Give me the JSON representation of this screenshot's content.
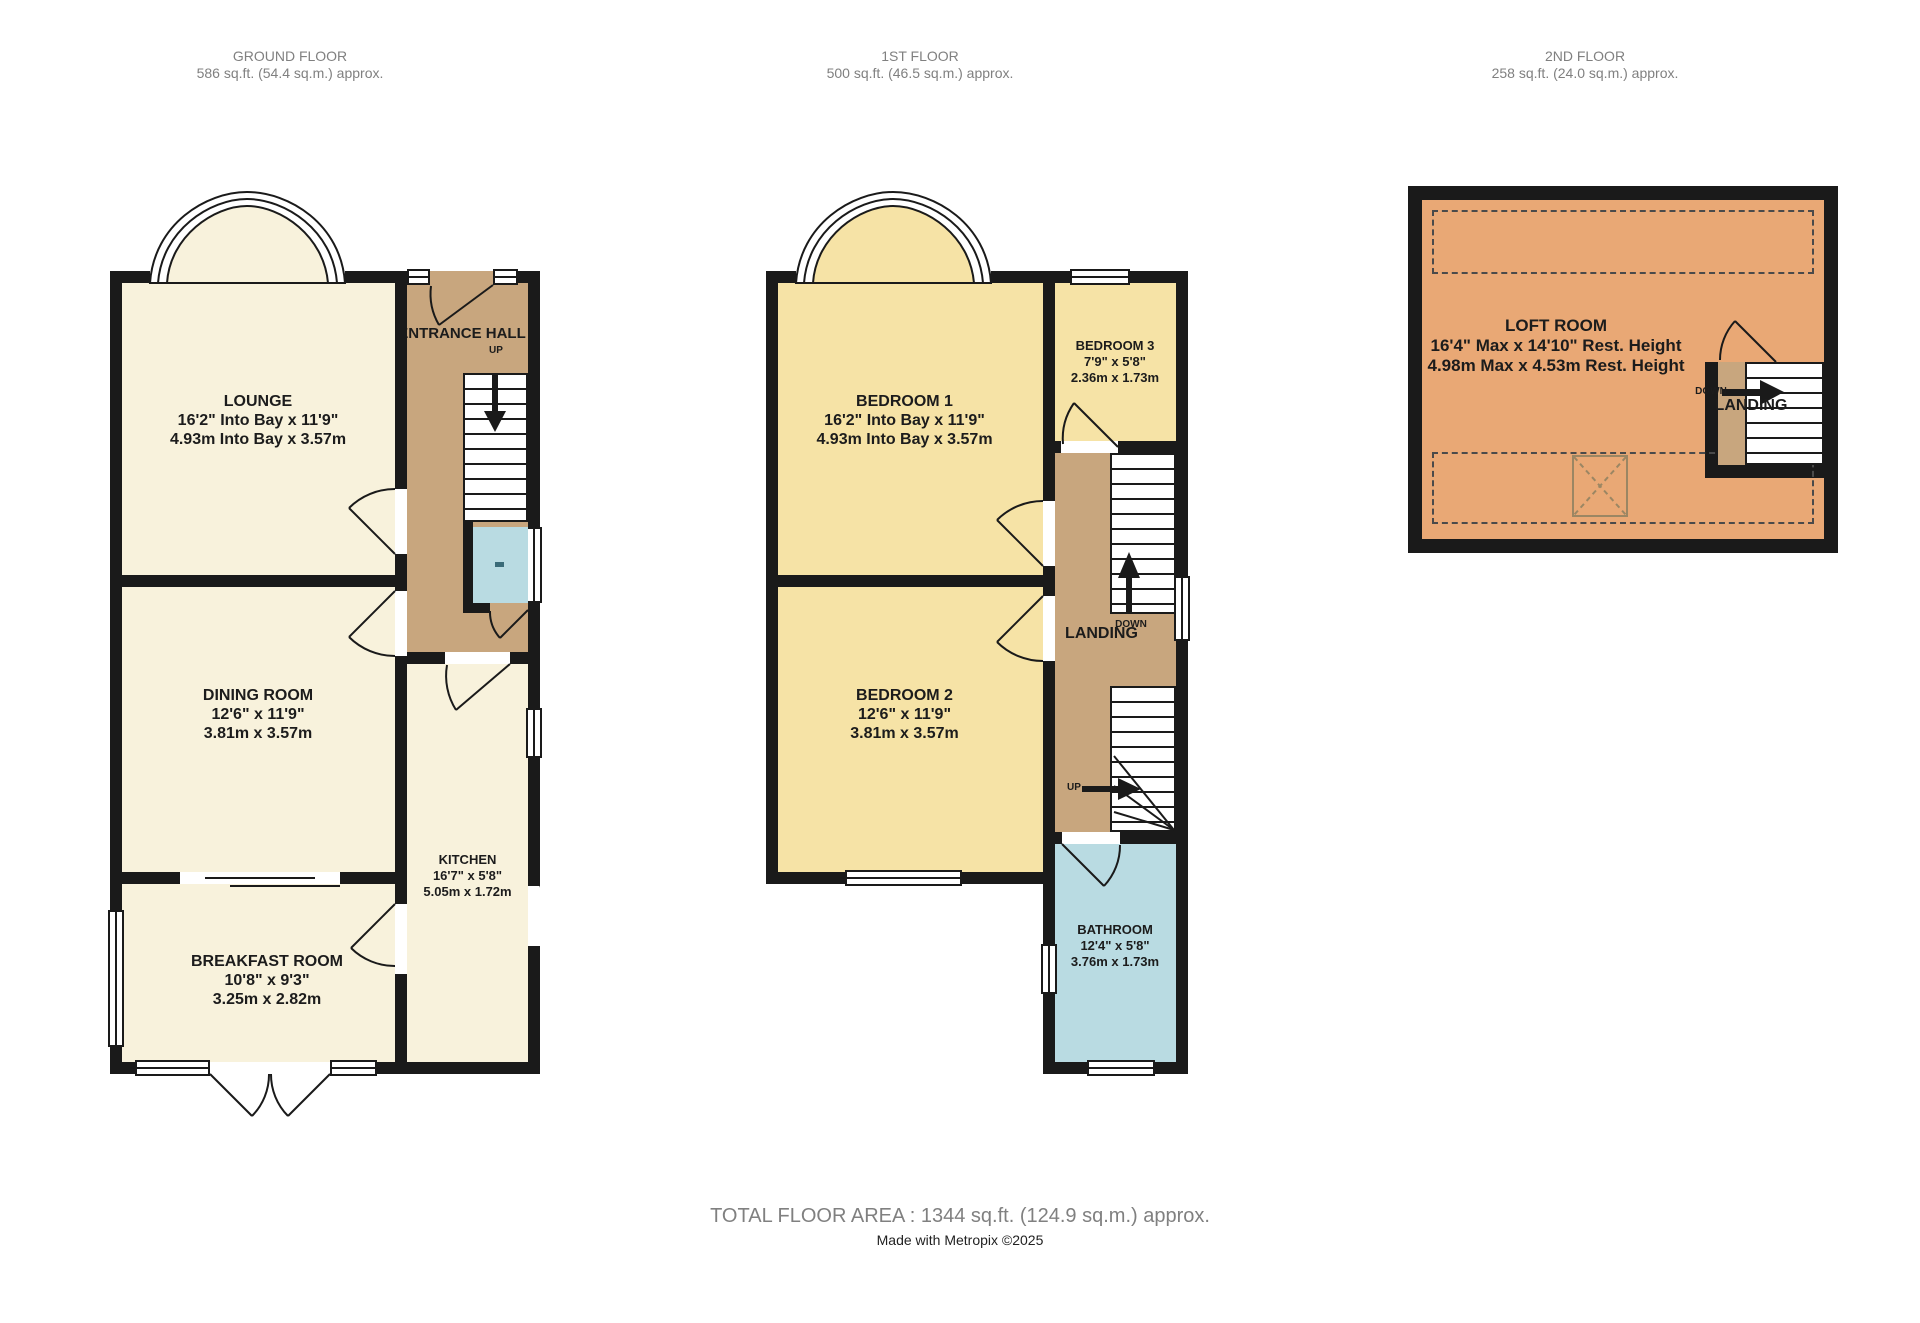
{
  "page": {
    "total_area": "TOTAL FLOOR AREA : 1344 sq.ft. (124.9 sq.m.) approx.",
    "credit": "Made with Metropix ©2025"
  },
  "colors": {
    "cream": "#f8f2dc",
    "tan": "#c8a67e",
    "yellow": "#f6e3a6",
    "blue": "#b9dbe2",
    "orange": "#e9a875",
    "wall": "#1a1a1a",
    "header_text": "#808080",
    "label_text": "#1c1c1c"
  },
  "floors": {
    "ground": {
      "title": "GROUND FLOOR",
      "area": "586 sq.ft. (54.4 sq.m.) approx.",
      "rooms": {
        "lounge": {
          "name": "LOUNGE",
          "imperial": "16'2\" Into Bay x 11'9\"",
          "metric": "4.93m Into Bay x 3.57m"
        },
        "entrance_hall": {
          "name": "ENTRANCE HALL"
        },
        "dining": {
          "name": "DINING ROOM",
          "imperial": "12'6\"  x 11'9\"",
          "metric": "3.81m  x 3.57m"
        },
        "kitchen": {
          "name": "KITCHEN",
          "imperial": "16'7\"  x 5'8\"",
          "metric": "5.05m  x 1.72m"
        },
        "breakfast": {
          "name": "BREAKFAST ROOM",
          "imperial": "10'8\"  x 9'3\"",
          "metric": "3.25m  x 2.82m"
        }
      },
      "labels": {
        "up": "UP"
      }
    },
    "first": {
      "title": "1ST FLOOR",
      "area": "500 sq.ft. (46.5 sq.m.) approx.",
      "rooms": {
        "bedroom1": {
          "name": "BEDROOM 1",
          "imperial": "16'2\" Into Bay x 11'9\"",
          "metric": "4.93m Into Bay x 3.57m"
        },
        "bedroom2": {
          "name": "BEDROOM 2",
          "imperial": "12'6\"  x 11'9\"",
          "metric": "3.81m  x 3.57m"
        },
        "bedroom3": {
          "name": "BEDROOM 3",
          "imperial": "7'9\"  x 5'8\"",
          "metric": "2.36m  x 1.73m"
        },
        "landing": {
          "name": "LANDING"
        },
        "bathroom": {
          "name": "BATHROOM",
          "imperial": "12'4\"  x 5'8\"",
          "metric": "3.76m  x 1.73m"
        }
      },
      "labels": {
        "up": "UP",
        "down": "DOWN"
      }
    },
    "second": {
      "title": "2ND FLOOR",
      "area": "258 sq.ft. (24.0 sq.m.) approx.",
      "rooms": {
        "loft": {
          "name": "LOFT ROOM",
          "imperial": "16'4\" Max x 14'10\" Rest. Height",
          "metric": "4.98m Max x 4.53m Rest. Height"
        },
        "landing": {
          "name": "LANDING"
        }
      },
      "labels": {
        "down": "DOWN"
      }
    }
  }
}
